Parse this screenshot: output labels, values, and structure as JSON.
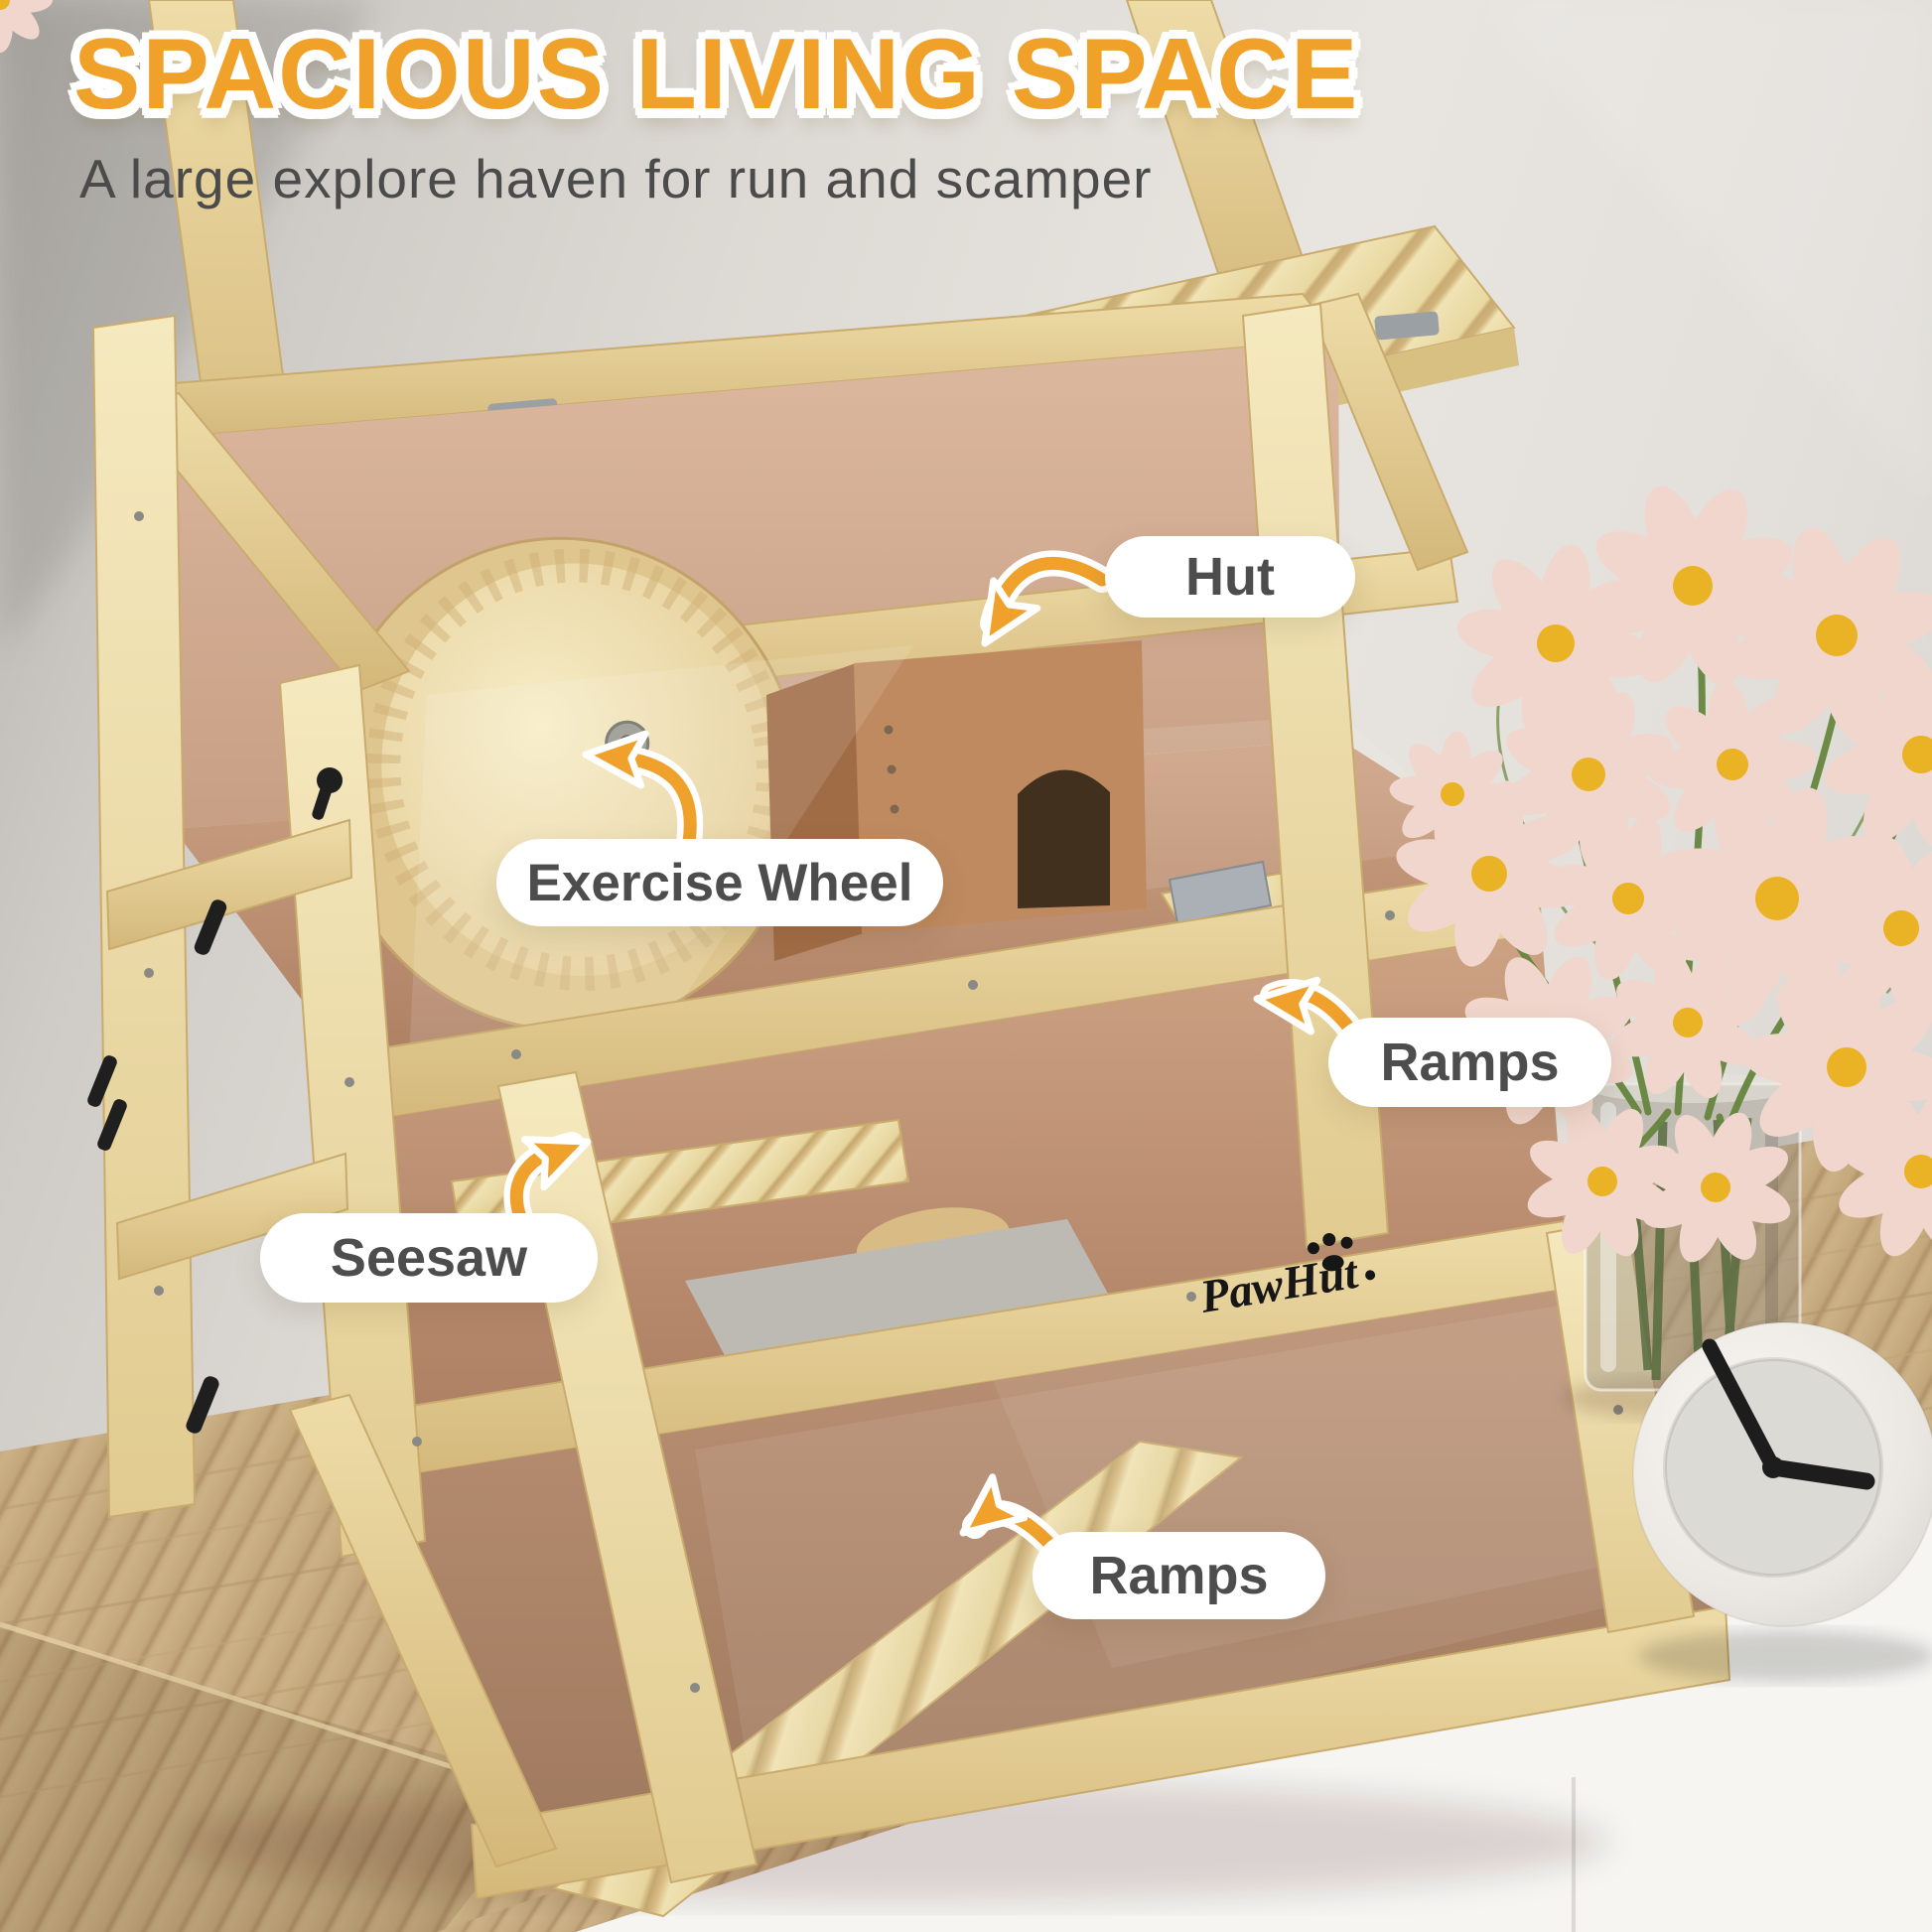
{
  "header": {
    "title": "SPACIOUS LIVING SPACE",
    "subtitle": "A large explore haven for run and scamper"
  },
  "callouts": [
    {
      "id": "hut",
      "label": "Hut"
    },
    {
      "id": "exercise-wheel",
      "label": "Exercise Wheel"
    },
    {
      "id": "ramps-upper",
      "label": "Ramps"
    },
    {
      "id": "seesaw",
      "label": "Seesaw"
    },
    {
      "id": "ramps-lower",
      "label": "Ramps"
    }
  ],
  "product": {
    "brand_logo": "PawHut"
  },
  "colors": {
    "accent_orange": "#F0A12B",
    "title_orange": "#EFA12A",
    "label_text": "#4D4D4D",
    "pill_background": "#FFFFFF"
  }
}
